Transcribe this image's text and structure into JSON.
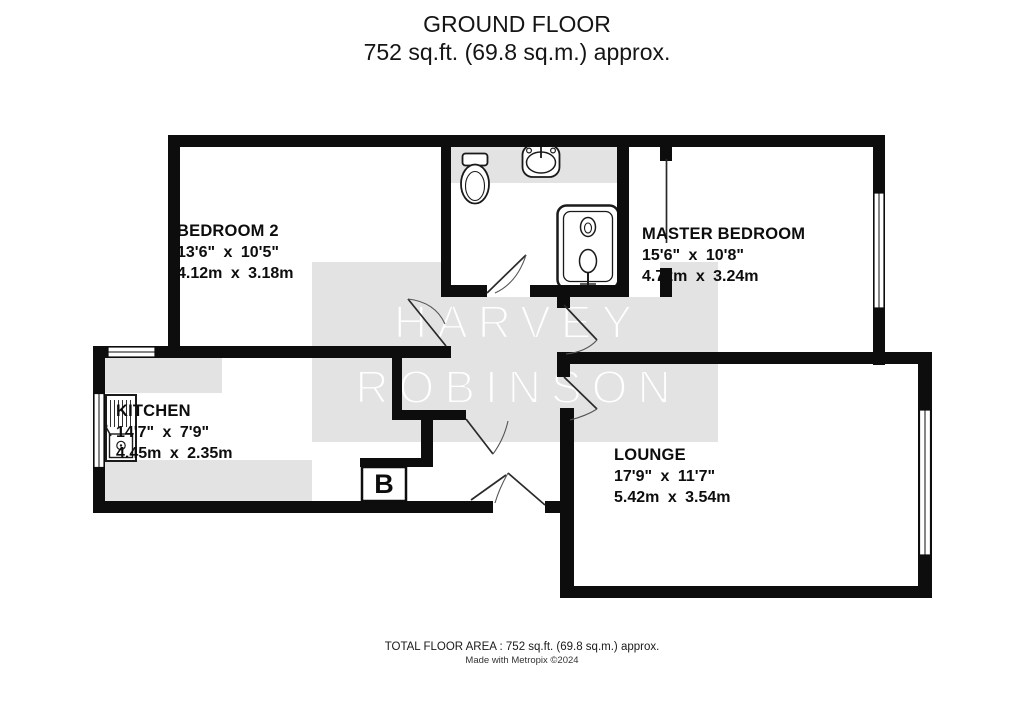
{
  "title": {
    "line1": "GROUND FLOOR",
    "line2": "752 sq.ft. (69.8 sq.m.) approx."
  },
  "watermark": {
    "word1": "HARVEY",
    "word2": "ROBINSON"
  },
  "rooms": {
    "bedroom2": {
      "name": "BEDROOM 2",
      "imperial": "13'6\" x 10'5\"",
      "metric": "4.12m x 3.18m"
    },
    "master": {
      "name": "MASTER BEDROOM",
      "imperial": "15'6\" x 10'8\"",
      "metric": "4.72m x 3.24m"
    },
    "kitchen": {
      "name": "KITCHEN",
      "imperial": "14'7\" x 7'9\"",
      "metric": "4.45m x 2.35m"
    },
    "lounge": {
      "name": "LOUNGE",
      "imperial": "17'9\" x 11'7\"",
      "metric": "5.42m x 3.54m"
    }
  },
  "markers": {
    "boiler": "B"
  },
  "fixtures": [
    "toilet",
    "basin",
    "shower",
    "kitchen-sink"
  ],
  "footer": {
    "line1": "TOTAL FLOOR AREA : 752 sq.ft. (69.8 sq.m.) approx.",
    "line2": "Made with Metropix ©2024"
  },
  "colors": {
    "wall": "#0d0d0d",
    "floor": "#ffffff",
    "shade": "#e3e3e3",
    "watermark_text": "#ffffff",
    "text": "#111111"
  }
}
